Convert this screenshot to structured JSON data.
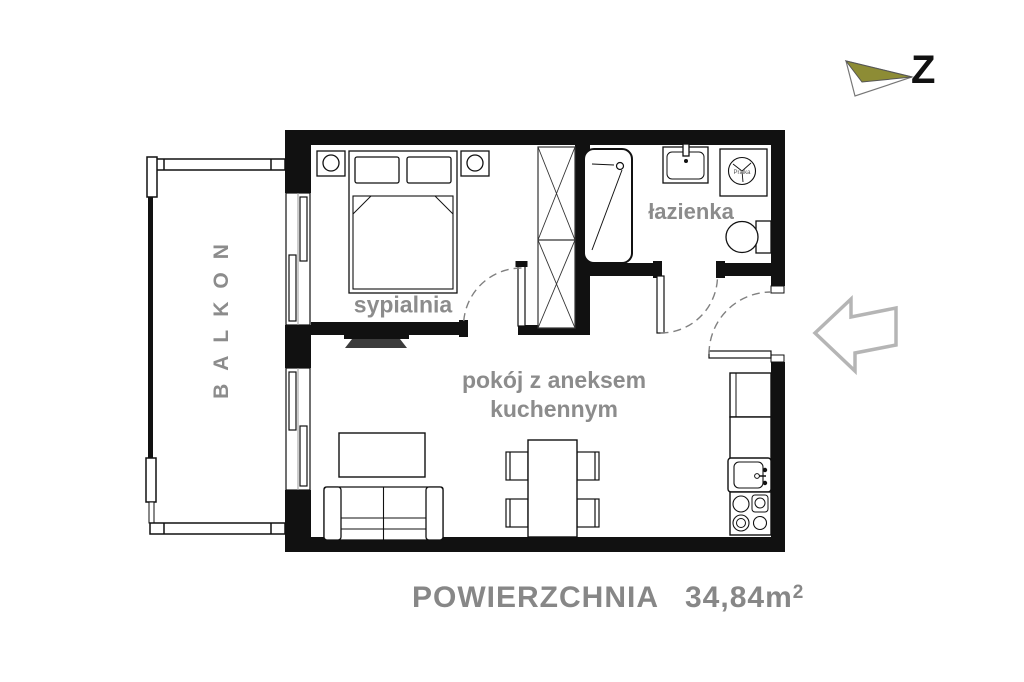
{
  "labels": {
    "balcony": "BALKON",
    "bedroom": "sypialnia",
    "bathroom": "łazienka",
    "living_room_line1": "pokój z aneksem",
    "living_room_line2": "kuchennym",
    "washing_machine": "Pralka",
    "compass": "Z"
  },
  "area": {
    "label": "POWIERZCHNIA",
    "value": "34,84m",
    "superscript": "2"
  },
  "colors": {
    "wall_black": "#111111",
    "label_gray": "#8c8c8c",
    "area_gray": "#878787",
    "compass_olive": "#8d8c35",
    "entry_arrow_gray": "#b5b5b5",
    "door_swing_gray": "#808080"
  }
}
